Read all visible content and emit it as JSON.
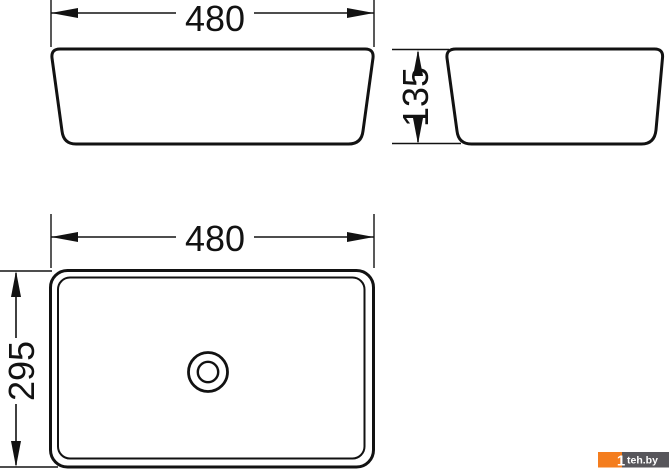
{
  "drawing": {
    "description": "Countertop washbasin dimensional drawing, three orthographic views",
    "front_view": {
      "width_label": "480"
    },
    "side_view": {
      "height_label": "135"
    },
    "plan_view": {
      "width_label": "480",
      "depth_label": "295"
    }
  },
  "watermark": {
    "prefix": "1",
    "site": "teh.by"
  },
  "colors": {
    "line": "#121212",
    "background": "#ffffff",
    "watermark_orange": "#f47d1e",
    "watermark_gray": "#57565b",
    "watermark_text": "#ffffff"
  }
}
